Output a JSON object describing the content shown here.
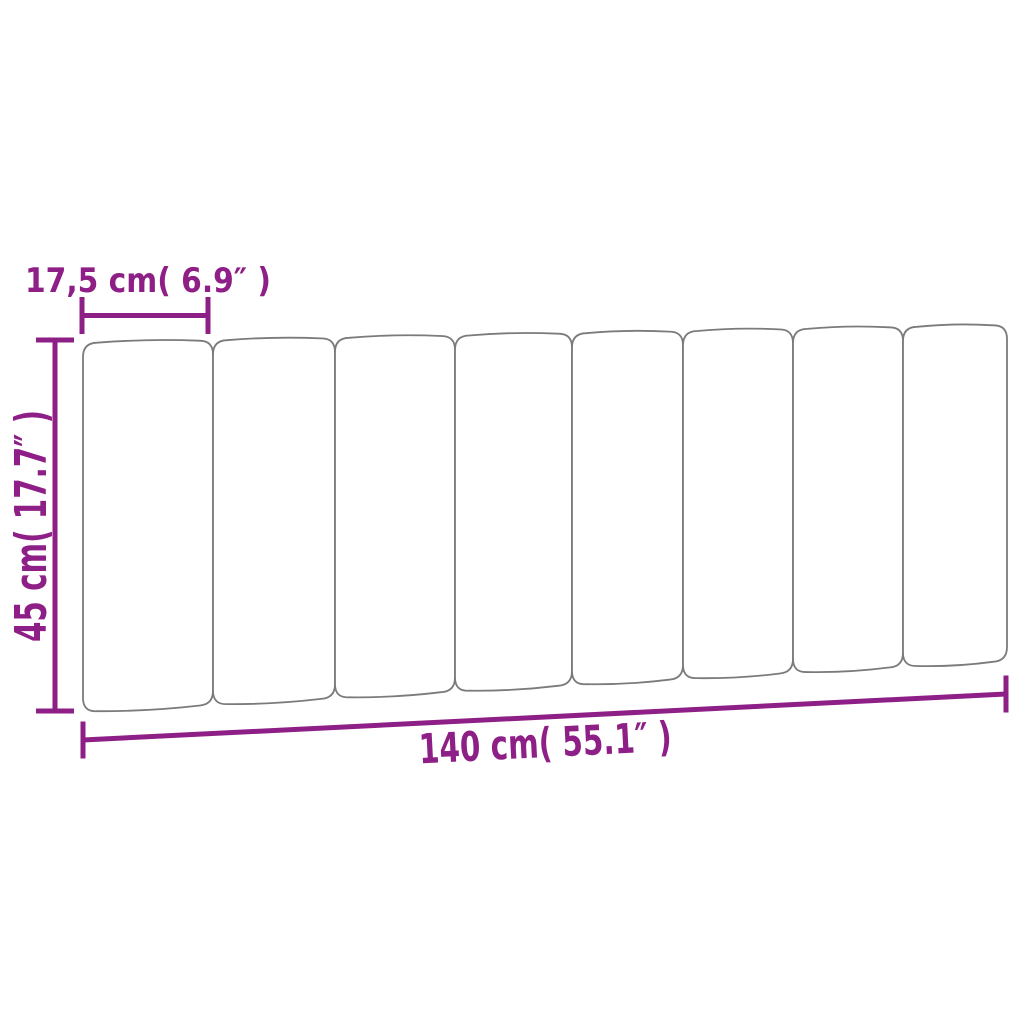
{
  "page": {
    "background": "#ffffff"
  },
  "diagram": {
    "type": "product-dimension-diagram",
    "subject": "upholstered headboard cushion with vertical panels",
    "labels": {
      "panel_width": "17,5 cm( 6.9″ )",
      "height": "45 cm( 17.7″ )",
      "width": "140 cm( 55.1″ )"
    },
    "colors": {
      "dimension": "#8e1f86",
      "panel_outline": "#7b7b7b",
      "panel_fill": "#ffffff",
      "background": "#ffffff"
    },
    "headboard": {
      "panel_count": 8,
      "boundaries_x": [
        83,
        213,
        335,
        455,
        572,
        683,
        793,
        903,
        1007
      ],
      "top_edge": {
        "x1": 83,
        "y1": 343,
        "x2": 1007,
        "y2": 325
      },
      "bottom_edge": {
        "x1": 83,
        "y1": 712,
        "x2": 1007,
        "y2": 661
      },
      "corner_radius": 14,
      "edge_arch": 3
    }
  }
}
